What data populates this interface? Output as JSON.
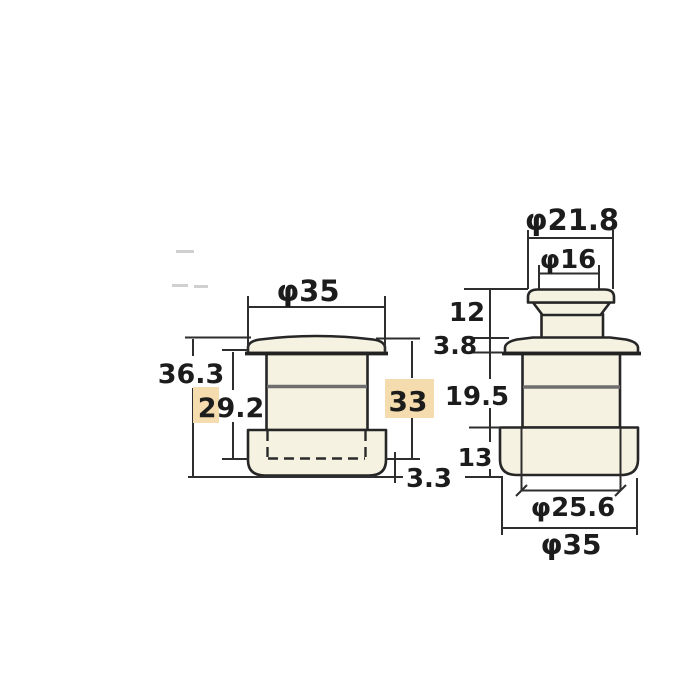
{
  "colors": {
    "background": "#ffffff",
    "part_fill": "#f5f2e2",
    "outline": "#262626",
    "inner_line": "#6e6e6e",
    "highlight": "#f4dcae",
    "text": "#1c1c1c"
  },
  "left_view": {
    "dia_top": "φ35",
    "total_height": "36.3",
    "inner_height": "29.2",
    "side_height": "33",
    "bottom_offset": "3.3"
  },
  "right_view": {
    "dia_cap": "φ21.8",
    "dia_stem": "φ16",
    "knob_height": "12",
    "flange_height": "3.8",
    "body_height": "19.5",
    "base_height": "13",
    "dia_base_inner": "φ25.6",
    "dia_base_outer": "φ35"
  }
}
